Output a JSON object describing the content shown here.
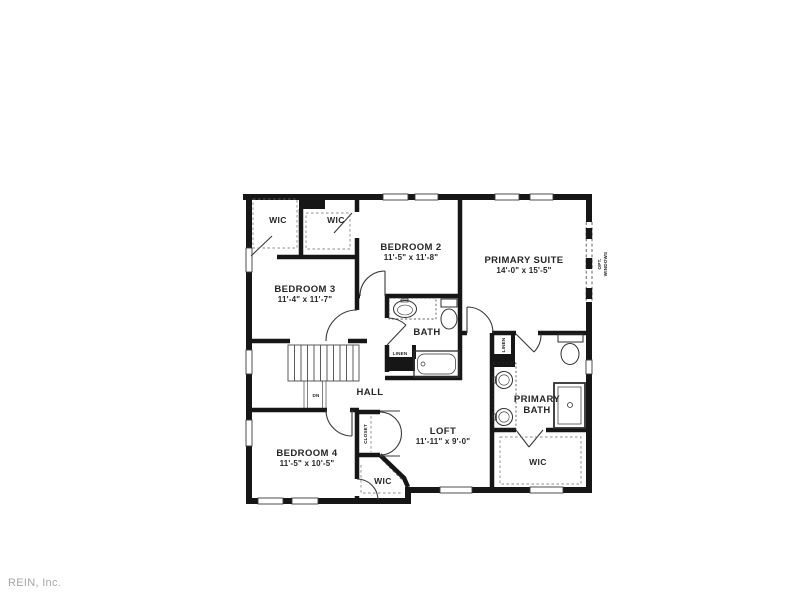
{
  "watermark": "REIN, Inc.",
  "colors": {
    "wall": "#161616",
    "text": "#262626",
    "door": "#3a3a3a",
    "watermark_gray": "#a6a6a6"
  },
  "rooms": {
    "wic_a": {
      "label": "WIC"
    },
    "wic_b": {
      "label": "WIC"
    },
    "bedroom2": {
      "label": "BEDROOM 2",
      "dims": "11'-5\" x 11'-8\""
    },
    "bedroom3": {
      "label": "BEDROOM 3",
      "dims": "11'-4\" x 11'-7\""
    },
    "bedroom4": {
      "label": "BEDROOM 4",
      "dims": "11'-5\" x 10'-5\""
    },
    "primary_suite": {
      "label": "PRIMARY SUITE",
      "dims": "14'-0\" x 15'-5\""
    },
    "bath": {
      "label": "BATH"
    },
    "hall": {
      "label": "HALL"
    },
    "loft": {
      "label": "LOFT",
      "dims": "11'-11\" x 9'-0\""
    },
    "primary_bath": {
      "line1": "PRIMARY",
      "line2": "BATH"
    },
    "wic_bedroom4": {
      "label": "WIC"
    },
    "wic_primary": {
      "label": "WIC"
    }
  },
  "annotations": {
    "closet": "CLOSET",
    "linen_bath": "LINEN",
    "linen_primary": "LINEN",
    "down": "DN",
    "opt_line1": "OPT.",
    "opt_line2": "WINDOWS"
  }
}
